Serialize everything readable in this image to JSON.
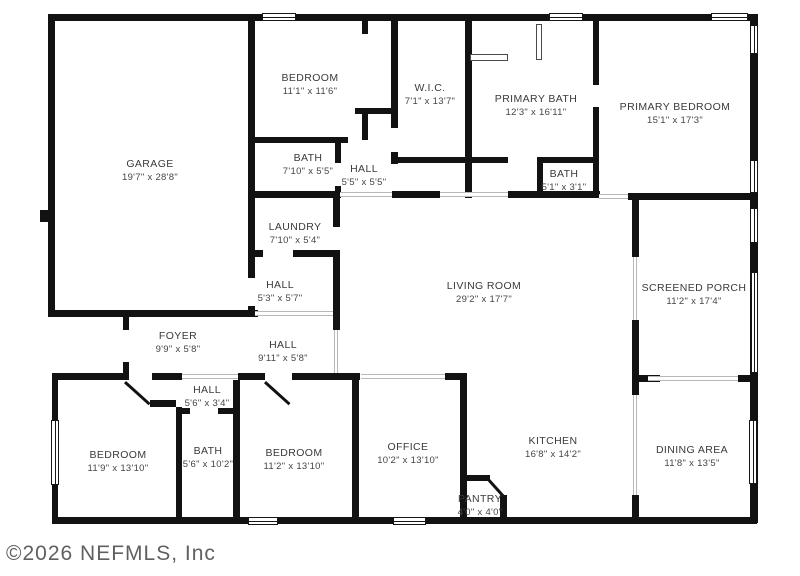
{
  "watermark": {
    "text": "©2026 NEFMLS, Inc"
  },
  "palette": {
    "wall": "#121212",
    "label": "#3a3a3a",
    "background": "#ffffff",
    "opening_line": "#b8b8b8",
    "watermark_color": "#4f4f4f"
  },
  "floor_plan": {
    "rooms": [
      {
        "name": "GARAGE",
        "dims": "19'7\" x 28'8\"",
        "cx": 150,
        "cy": 171
      },
      {
        "name": "BEDROOM",
        "dims": "11'1\" x 11'6\"",
        "cx": 310,
        "cy": 85
      },
      {
        "name": "W.I.C.",
        "dims": "7'1\" x 13'7\"",
        "cx": 430,
        "cy": 95
      },
      {
        "name": "PRIMARY BATH",
        "dims": "12'3\" x 16'11\"",
        "cx": 536,
        "cy": 106
      },
      {
        "name": "PRIMARY BEDROOM",
        "dims": "15'1\" x 17'3\"",
        "cx": 675,
        "cy": 114
      },
      {
        "name": "BATH",
        "dims": "7'10\" x 5'5\"",
        "cx": 308,
        "cy": 165
      },
      {
        "name": "HALL",
        "dims": "5'5\" x 5'5\"",
        "cx": 364,
        "cy": 176
      },
      {
        "name": "BATH",
        "dims": "5'1\" x 3'1\"",
        "cx": 564,
        "cy": 181
      },
      {
        "name": "LAUNDRY",
        "dims": "7'10\" x 5'4\"",
        "cx": 295,
        "cy": 234
      },
      {
        "name": "HALL",
        "dims": "5'3\" x 5'7\"",
        "cx": 280,
        "cy": 292
      },
      {
        "name": "LIVING ROOM",
        "dims": "29'2\" x 17'7\"",
        "cx": 484,
        "cy": 293
      },
      {
        "name": "SCREENED PORCH",
        "dims": "11'2\" x 17'4\"",
        "cx": 694,
        "cy": 295
      },
      {
        "name": "FOYER",
        "dims": "9'9\" x 5'8\"",
        "cx": 178,
        "cy": 343
      },
      {
        "name": "HALL",
        "dims": "9'11\" x 5'8\"",
        "cx": 283,
        "cy": 352
      },
      {
        "name": "HALL",
        "dims": "5'6\" x 3'4\"",
        "cx": 207,
        "cy": 397
      },
      {
        "name": "BEDROOM",
        "dims": "11'9\" x 13'10\"",
        "cx": 118,
        "cy": 462
      },
      {
        "name": "BATH",
        "dims": "5'6\" x 10'2\"",
        "cx": 208,
        "cy": 458
      },
      {
        "name": "BEDROOM",
        "dims": "11'2\" x 13'10\"",
        "cx": 294,
        "cy": 460
      },
      {
        "name": "OFFICE",
        "dims": "10'2\" x 13'10\"",
        "cx": 408,
        "cy": 454
      },
      {
        "name": "KITCHEN",
        "dims": "16'8\" x 14'2\"",
        "cx": 553,
        "cy": 448
      },
      {
        "name": "PANTRY",
        "dims": "4'0\" x 4'0\"",
        "cx": 480,
        "cy": 506
      },
      {
        "name": "DINING AREA",
        "dims": "11'8\" x 13'5\"",
        "cx": 692,
        "cy": 457
      }
    ]
  }
}
